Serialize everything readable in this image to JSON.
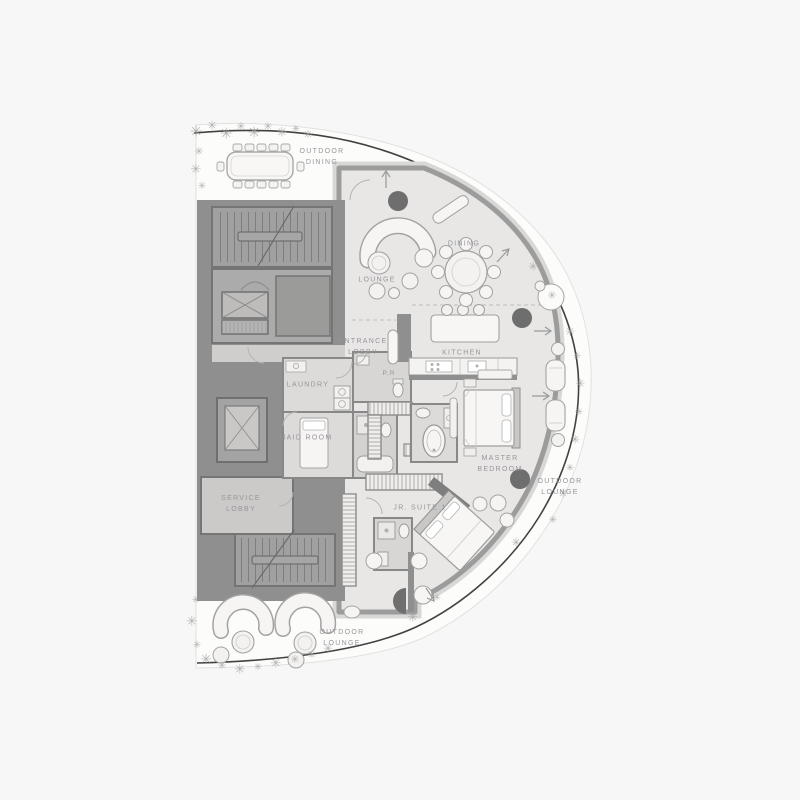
{
  "labels": {
    "outdoor_dining": "OUTDOOR\nDINING",
    "dining": "DINING",
    "lounge": "LOUNGE",
    "entrance_lobby": "ENTRANCE\nLOBBY",
    "kitchen": "KITCHEN",
    "powder_room": "P.R",
    "laundry": "LAUNDRY",
    "maid_room": "MAID ROOM",
    "service_lobby": "SERVICE\nLOBBY",
    "jr_suite_1": "JR. SUITE 1",
    "master_bedroom": "MASTER\nBEDROOM",
    "outdoor_lounge_right": "OUTDOOR\nLOUNGE",
    "outdoor_lounge_bottom": "OUTDOOR\nLOUNGE"
  },
  "icons": {
    "tree": "✳"
  },
  "palette": {
    "background": "#f8f7f7",
    "terrace": "#fcfcfb",
    "floor": "#e8e7e6",
    "wall": "#9c9c9c",
    "core": "#8f8f8f",
    "rail": "#424242",
    "column": "#6e6e6e",
    "furniture_stroke": "#a3a3a3",
    "label_text": "#96959a"
  },
  "decor": {
    "trees": [
      {
        "x": 196,
        "y": 132,
        "s": 15
      },
      {
        "x": 212,
        "y": 126,
        "s": 12
      },
      {
        "x": 226,
        "y": 134,
        "s": 15
      },
      {
        "x": 241,
        "y": 127,
        "s": 11
      },
      {
        "x": 254,
        "y": 133,
        "s": 15
      },
      {
        "x": 268,
        "y": 127,
        "s": 11
      },
      {
        "x": 282,
        "y": 133,
        "s": 13
      },
      {
        "x": 296,
        "y": 129,
        "s": 10
      },
      {
        "x": 308,
        "y": 135,
        "s": 11
      },
      {
        "x": 199,
        "y": 152,
        "s": 11
      },
      {
        "x": 196,
        "y": 170,
        "s": 13
      },
      {
        "x": 202,
        "y": 186,
        "s": 10
      },
      {
        "x": 533,
        "y": 267,
        "s": 12
      },
      {
        "x": 552,
        "y": 296,
        "s": 11
      },
      {
        "x": 570,
        "y": 332,
        "s": 12
      },
      {
        "x": 577,
        "y": 356,
        "s": 10
      },
      {
        "x": 580,
        "y": 384,
        "s": 12
      },
      {
        "x": 579,
        "y": 412,
        "s": 10
      },
      {
        "x": 575,
        "y": 440,
        "s": 12
      },
      {
        "x": 570,
        "y": 468,
        "s": 10
      },
      {
        "x": 563,
        "y": 494,
        "s": 12
      },
      {
        "x": 553,
        "y": 520,
        "s": 10
      },
      {
        "x": 516,
        "y": 543,
        "s": 12
      },
      {
        "x": 196,
        "y": 600,
        "s": 10
      },
      {
        "x": 192,
        "y": 622,
        "s": 13
      },
      {
        "x": 197,
        "y": 645,
        "s": 10
      },
      {
        "x": 206,
        "y": 660,
        "s": 14
      },
      {
        "x": 222,
        "y": 666,
        "s": 11
      },
      {
        "x": 240,
        "y": 670,
        "s": 13
      },
      {
        "x": 258,
        "y": 667,
        "s": 10
      },
      {
        "x": 276,
        "y": 664,
        "s": 13
      },
      {
        "x": 295,
        "y": 660,
        "s": 11
      },
      {
        "x": 312,
        "y": 655,
        "s": 10
      },
      {
        "x": 328,
        "y": 649,
        "s": 12
      },
      {
        "x": 413,
        "y": 618,
        "s": 13
      },
      {
        "x": 437,
        "y": 598,
        "s": 9
      }
    ]
  }
}
